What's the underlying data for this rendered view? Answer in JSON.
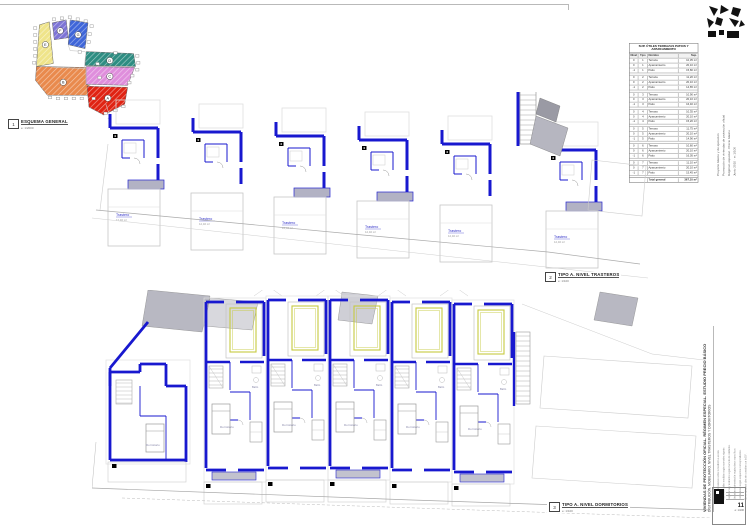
{
  "sheet": {
    "keyplan": {
      "icon_number": "1",
      "label": "ESQUEMA GENERAL",
      "scale": "e: 1/2000"
    },
    "plans": [
      {
        "icon_number": "2",
        "label": "TIPO A. NIVEL TRASTEROS",
        "scale": "e: 1/100"
      },
      {
        "icon_number": "3",
        "label": "TIPO A. NIVEL DORMITORIOS",
        "scale": "e: 1/100"
      }
    ]
  },
  "rooms": {
    "trastero": "Trastero",
    "trastero_area": "12,40 m²",
    "dormitorio": "Dormitorio",
    "banyo": "Baño"
  },
  "table": {
    "title": [
      "SUP. ÚTILES TERRAZAS PATIOS Y",
      "APARCAMIENTO"
    ],
    "headers": [
      "Nivel",
      "Tipo",
      "Nombre",
      "Sup."
    ],
    "groups": [
      {
        "rows": [
          [
            "0",
            "1",
            "Terraza",
            "10,35 m²"
          ],
          [
            "0",
            "1",
            "Aparcamiento",
            "20,10 m²"
          ],
          [
            "-1",
            "1",
            "Patio",
            "15,80 m²"
          ]
        ]
      },
      {
        "rows": [
          [
            "0",
            "2",
            "Terraza",
            "11,20 m²"
          ],
          [
            "0",
            "2",
            "Aparcamiento",
            "20,10 m²"
          ],
          [
            "-1",
            "2",
            "Patio",
            "14,65 m²"
          ]
        ]
      },
      {
        "rows": [
          [
            "0",
            "3",
            "Terraza",
            "10,90 m²"
          ],
          [
            "0",
            "3",
            "Aparcamiento",
            "20,10 m²"
          ],
          [
            "-1",
            "3",
            "Patio",
            "16,40 m²"
          ]
        ]
      },
      {
        "rows": [
          [
            "0",
            "4",
            "Terraza",
            "10,35 m²"
          ],
          [
            "0",
            "4",
            "Aparcamiento",
            "20,10 m²"
          ],
          [
            "-1",
            "4",
            "Patio",
            "15,20 m²"
          ]
        ]
      },
      {
        "rows": [
          [
            "0",
            "5",
            "Terraza",
            "11,75 m²"
          ],
          [
            "0",
            "5",
            "Aparcamiento",
            "20,10 m²"
          ],
          [
            "-1",
            "5",
            "Patio",
            "14,90 m²"
          ]
        ]
      },
      {
        "rows": [
          [
            "0",
            "6",
            "Terraza",
            "10,60 m²"
          ],
          [
            "0",
            "6",
            "Aparcamiento",
            "20,10 m²"
          ],
          [
            "-1",
            "6",
            "Patio",
            "16,05 m²"
          ]
        ]
      },
      {
        "rows": [
          [
            "0",
            "7",
            "Terraza",
            "11,10 m²"
          ],
          [
            "0",
            "7",
            "Aparcamiento",
            "20,10 m²"
          ],
          [
            "-1",
            "7",
            "Patio",
            "15,45 m²"
          ]
        ]
      }
    ],
    "total_label": "Total general",
    "total_value": "367,10 m²"
  },
  "titleblock": {
    "top_lines": [
      "Proyecto básico y de ejecución",
      "Promoción de viviendas de protección oficial",
      "Régimen especial · Precio básico",
      "Junio 2010 · e: 1/100"
    ],
    "title_main": "VIVIENDAS DE PROTECCIÓN OFICIAL. RÉGIMEN ESPECIAL. ESTUDIO PRECIO BÁSICO",
    "title_sub": "DISTRIBUCIÓN. MOBILIARIO. NIVEL TRASTEROS Y DORMITORIOS",
    "notes_lines": [
      "Las cotas prevalecen sobre la medición a escala.",
      "Superficies útiles medidas según normativa vigente.",
      "Carpinterías y acabados según memoria de calidades.",
      "Estructura y cimentación según planos específicos.",
      "Instalaciones según esquemas correspondientes.",
      "No se ejecutará obra sin consultar con la D.F."
    ],
    "stamp": {
      "label": "PLANO",
      "number": "11",
      "scale": "e: 1/100"
    }
  },
  "keyplan_zones": [
    {
      "letter": "E",
      "color": "#efe48a"
    },
    {
      "letter": "F",
      "color": "#7d74d6"
    },
    {
      "letter": "G",
      "color": "#3f66d9"
    },
    {
      "letter": "D",
      "color": "#2e8d82"
    },
    {
      "letter": "C",
      "color": "#df8edc"
    },
    {
      "letter": "B",
      "color": "#e98a4d"
    },
    {
      "letter": "A",
      "color": "#e02313"
    }
  ],
  "colors": {
    "wall_blue": "#1818cf",
    "slab_gray": "#b2b2c4",
    "bed_yellow": "#c6ca40"
  }
}
